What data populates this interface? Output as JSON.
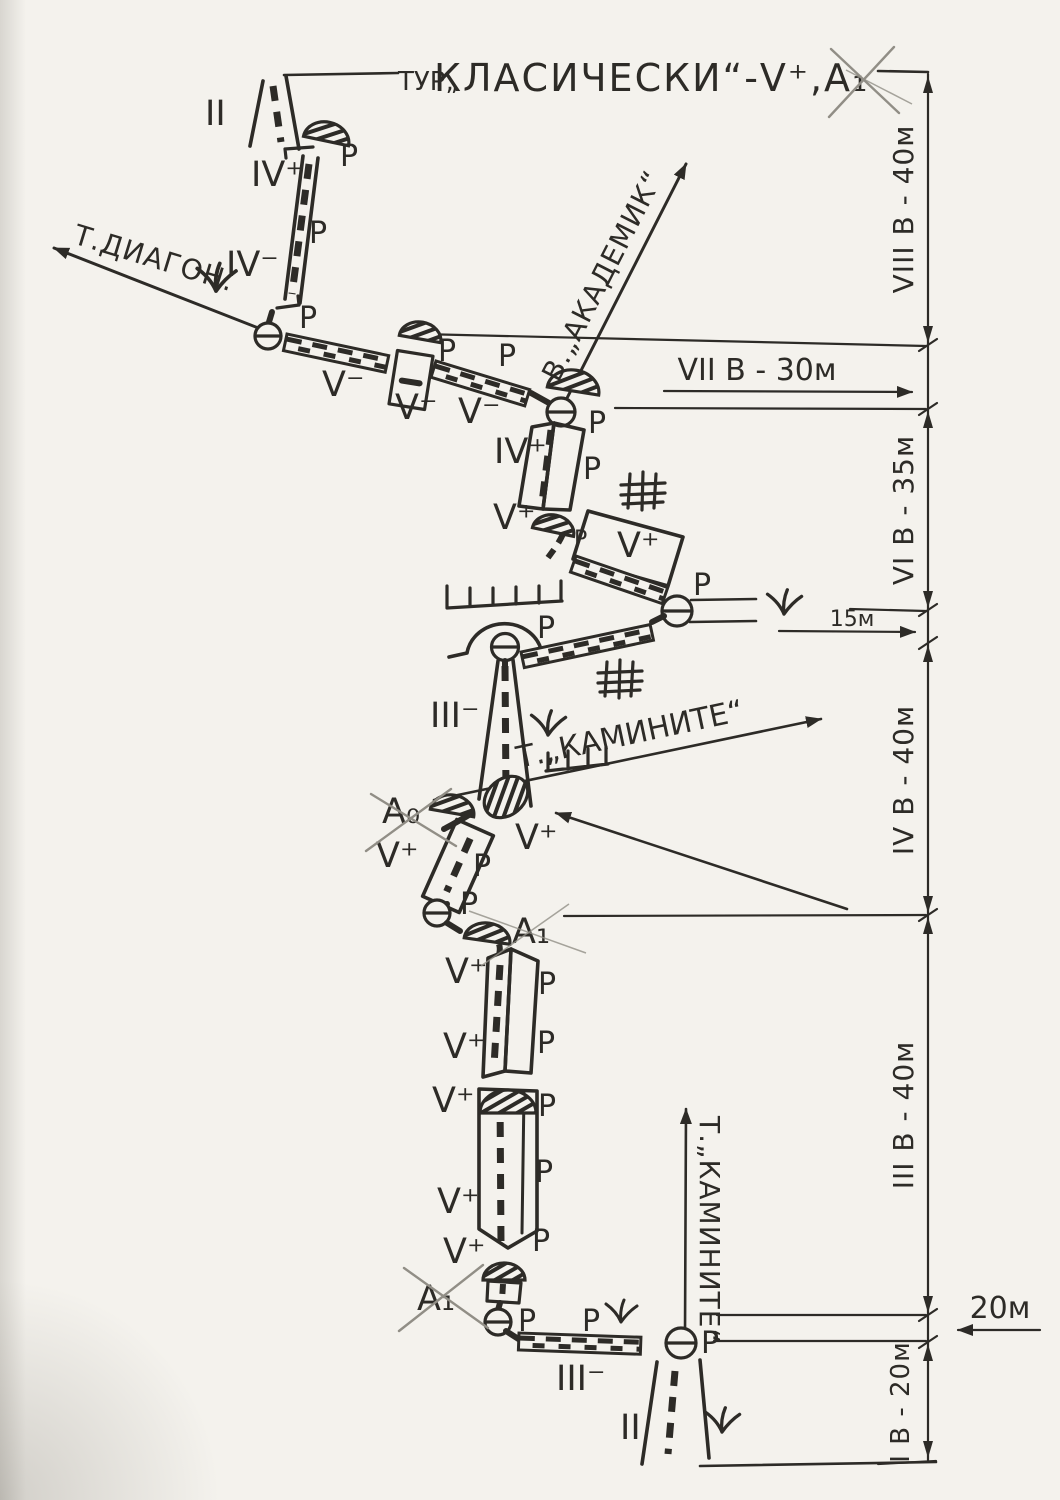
{
  "colors": {
    "paper": "#f4f2ed",
    "ink": "#2d2b27",
    "pencil": "#918e86"
  },
  "title": {
    "prefix": "ТУР„",
    "main": "КЛАСИЧЕСКИ“-V⁺,А₁"
  },
  "piton_symbol": "P",
  "grades": {
    "ii_top": "II",
    "iv_plus_top": "IV⁺",
    "iv_minus": "IV⁻",
    "v_minus_1": "V⁻",
    "v_minus_2": "V⁻",
    "v_minus_3": "V⁻",
    "iv_plus_mid": "IV⁺",
    "v_plus_1": "V⁺",
    "v_plus_2": "V⁺",
    "v_plus_3": "V⁺",
    "v_plus_4": "V⁺",
    "v_plus_5": "V⁺",
    "v_plus_6": "V⁺",
    "v_plus_7": "V⁺",
    "v_plus_8": "V⁺",
    "v_plus_9": "V⁺",
    "iii_minus_1": "III⁻",
    "iii_minus_2": "III⁻",
    "a0": "А₀",
    "a1_mid": "А₁",
    "a1_bottom": "А₁",
    "ii_bottom": "II"
  },
  "dimensions": {
    "pitch8": "VIII В - 40м",
    "pitch7": "VII В - 30м",
    "pitch6": "VI В - 35м",
    "traverse15": "15м",
    "pitch4": "IV В - 40м",
    "pitch3": "III В - 40м",
    "traverse20": "20м",
    "pitch1": "I В - 20м"
  },
  "directions": {
    "diagon": "Т.ДИАГОН.",
    "akademik": "В.„АКАДЕМИК“",
    "kaminite_mid": "Т.„КАМИНИТЕ“",
    "kaminite_bottom": "Т.„КАМИНИТЕ“"
  }
}
